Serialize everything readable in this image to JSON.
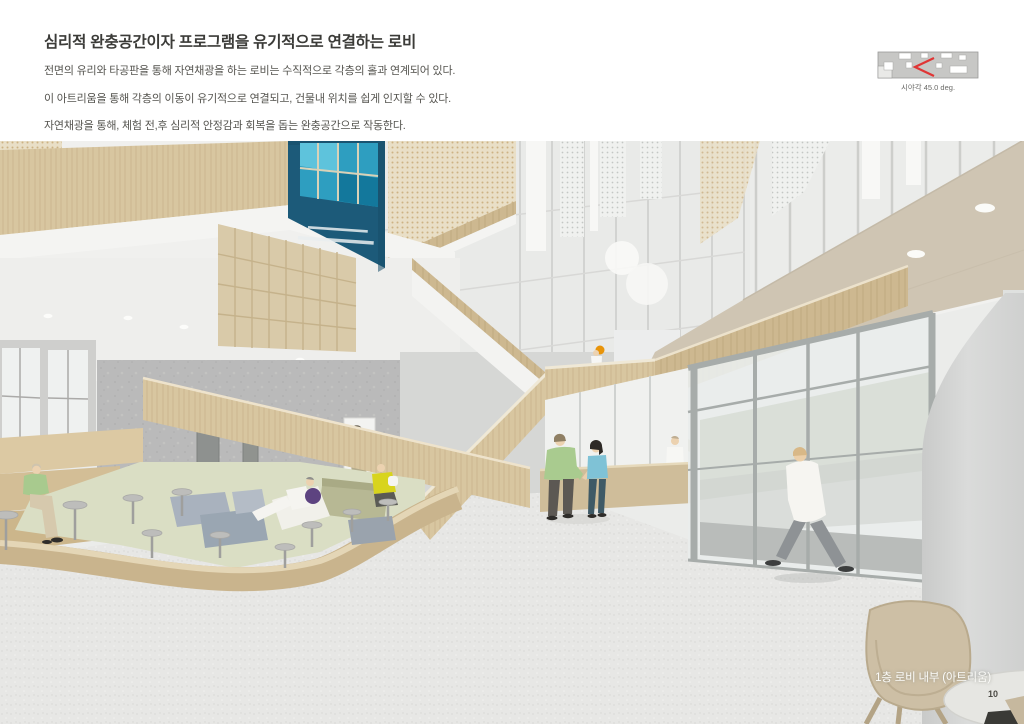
{
  "header": {
    "title": "심리적 완충공간이자 프로그램을 유기적으로 연결하는 로비",
    "paragraph_lines": [
      "전면의 유리와 타공판을 통해 자연채광을 하는 로비는 수직적으로 각층의 홀과 연계되어 있다.",
      "이 아트리움을 통해 각층의 이동이 유기적으로 연결되고, 건물내 위치를 쉽게 인지할 수 있다.",
      "자연채광을 통해, 체험 전,후 심리적 안정감과 회복을 돕는 완충공간으로 작동한다."
    ],
    "view_diagram": {
      "caption": "시야각 45.0 deg.",
      "marker_color": "#e03535"
    }
  },
  "rendering": {
    "caption": "1층 로비 내부 (아트리움)",
    "palette": {
      "banner_teal": "#1c5a79",
      "banner_window_blue": "#2e9ec0",
      "wood": "#d8c6a0",
      "ceiling_slab": "#cfc5b3",
      "concrete": "#bababa",
      "floor": "#e7e7e5",
      "rug_green": "#dadec4",
      "glass_mullion": "#a7acaa",
      "accent_orange": "#e8940a"
    }
  },
  "footer": {
    "page_number": "10"
  }
}
